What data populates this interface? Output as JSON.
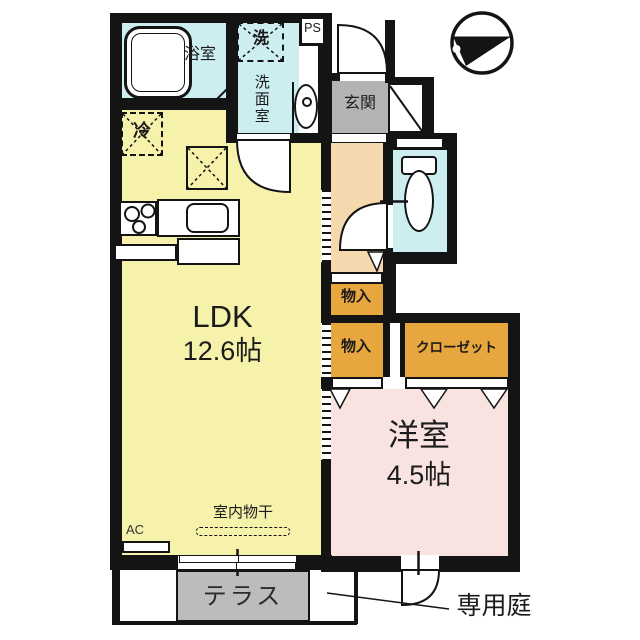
{
  "plan_title": "floor-plan",
  "colors": {
    "wall": "#141414",
    "ldk_fill": "#f7f2ab",
    "wet_area_fill": "#cdeef1",
    "hall_fill": "#f6d8ae",
    "storage_fill": "#e8a73e",
    "western_fill": "#f9e3e1",
    "entrance_fill": "#b3b3b3",
    "terrace_fill": "#bcbcbc"
  },
  "rooms": {
    "ldk": {
      "label": "LDK",
      "size": "12.6帖"
    },
    "western_room": {
      "label": "洋室",
      "size": "4.5帖"
    },
    "bathroom": {
      "label": "浴室"
    },
    "washroom": {
      "label": "洗面室"
    },
    "entrance": {
      "label": "玄関"
    },
    "storage_1": {
      "label": "物入"
    },
    "storage_2": {
      "label": "物入"
    },
    "closet": {
      "label": "クローゼット"
    },
    "terrace": {
      "label": "テラス"
    },
    "private_garden": {
      "label": "専用庭"
    }
  },
  "fixtures": {
    "washer_label": "洗",
    "fridge_label": "冷",
    "ps_label": "PS",
    "ac_label": "AC",
    "indoor_drying_label": "室内物干"
  }
}
